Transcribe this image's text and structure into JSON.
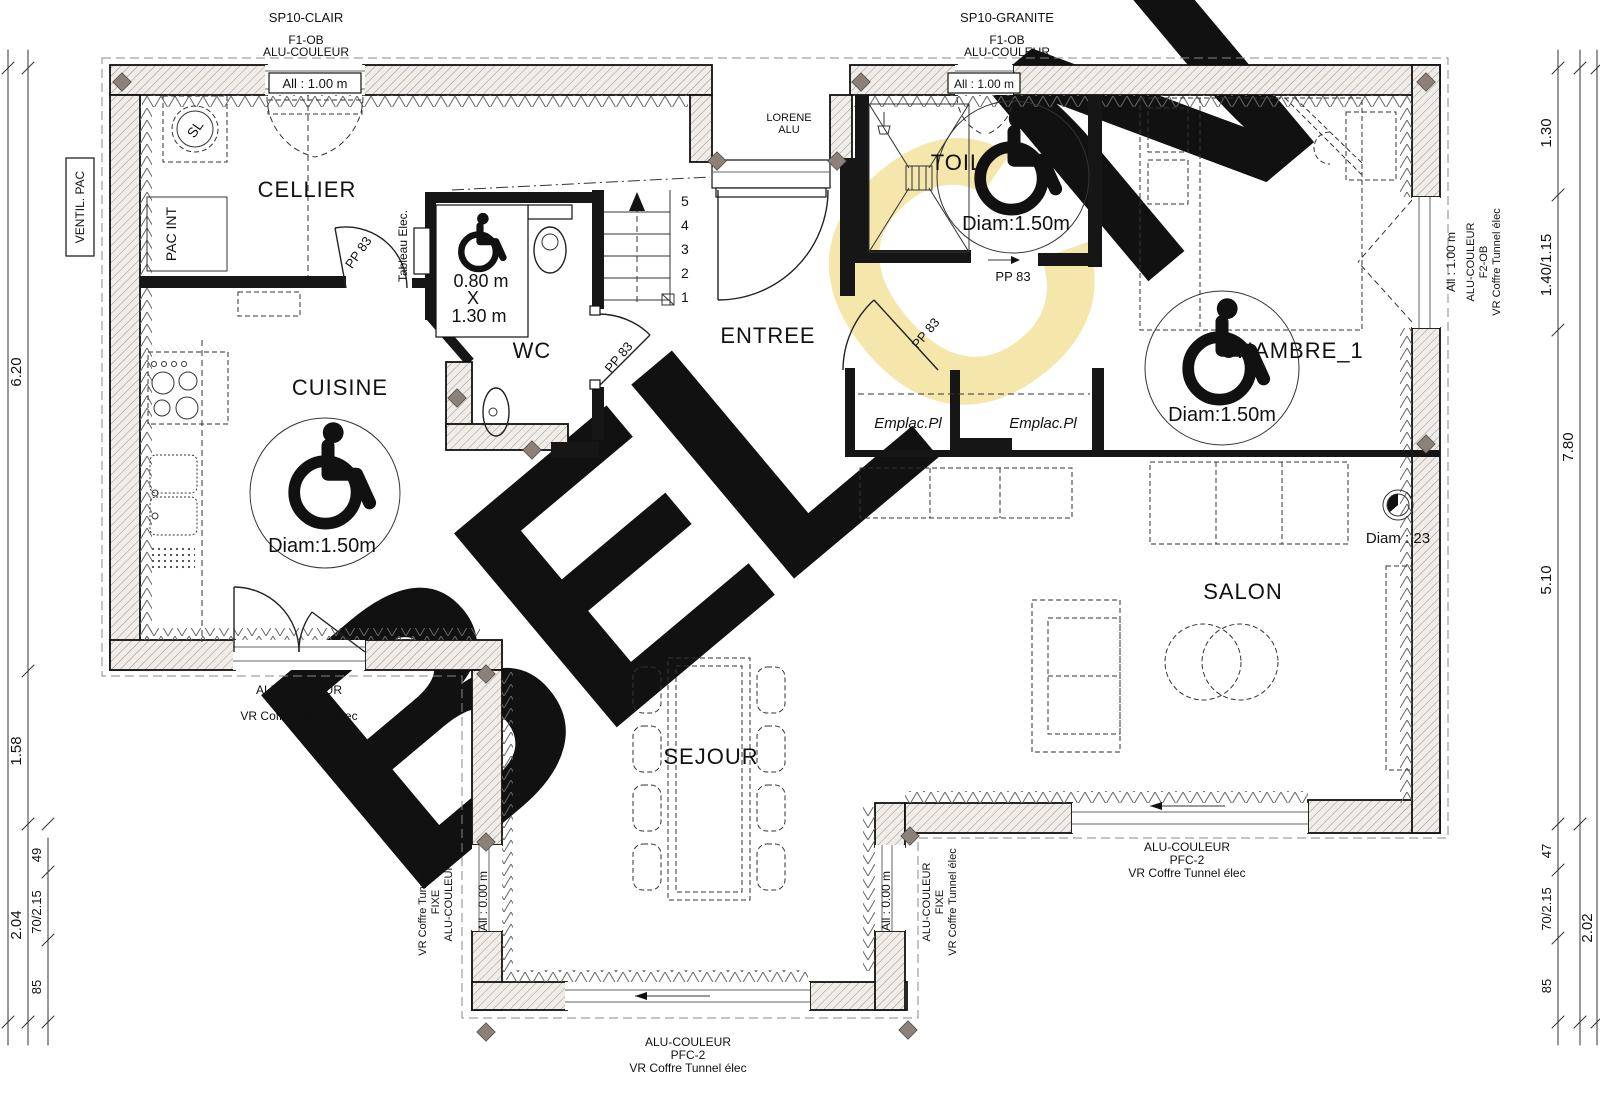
{
  "materials": {
    "left": "SP10-CLAIR",
    "right": "SP10-GRANITE"
  },
  "frames": {
    "ref": "F1-OB",
    "color": "ALU-COULEUR"
  },
  "entry": {
    "brand": "LORENE",
    "material": "ALU"
  },
  "sills": {
    "s100": "All : 1.00 m",
    "s000": "All : 0.00 m"
  },
  "door_ref": "PP 83",
  "rooms": {
    "cellier": "CELLIER",
    "cuisine": "CUISINE",
    "wc": "WC",
    "entree": "ENTREE",
    "toil": "TOIL",
    "chambre": "CHAMBRE_1",
    "salon": "SALON",
    "sejour": "SEJOUR"
  },
  "clearance": {
    "turn": "Diam:1.50m",
    "wc_w": "0.80 m",
    "wc_x": "X",
    "wc_h": "1.30 m"
  },
  "duct": "Diam : 23",
  "closet": "Emplac.Pl",
  "equipment": {
    "ventil": "VENTIL. PAC",
    "pac": "PAC INT",
    "tableau": "Tableau Elec.",
    "washer": "SL"
  },
  "windows": {
    "pf2": {
      "l1": "ALU-COULEUR",
      "l2": "PF2",
      "l3": "VR Coffre Tunnel élec"
    },
    "pfc2": {
      "l1": "ALU-COULEUR",
      "l2": "PFC-2",
      "l3": "VR Coffre Tunnel élec"
    },
    "fixe_left": {
      "l1": "VR Coffre Tunnel élec",
      "l2": "FIXE",
      "l3": "ALU-COULEUR"
    },
    "fixe_right": {
      "l1": "ALU-COULEUR",
      "l2": "FIXE",
      "l3": "VR Coffre Tunnel élec"
    },
    "f2ob": {
      "l1": "ALU-COULEUR",
      "l2": "F2-OB",
      "l3": "VR Coffre Tunnel élec"
    }
  },
  "stairs": {
    "s5": "5",
    "s4": "4",
    "s3": "3",
    "s2": "2",
    "s1": "1"
  },
  "dims": {
    "left": {
      "d620": "6.20",
      "d158": "1.58",
      "d204": "2.04",
      "d49": "49",
      "d70": "70/2.15",
      "d85": "85"
    },
    "right": {
      "d130": "1.30",
      "d140": "1.40/1.15",
      "d780": "7.80",
      "d510": "5.10",
      "d47": "47",
      "d70": "70/2.15",
      "d202": "2.02",
      "d85": "85"
    }
  },
  "watermark": {
    "b": "B",
    "e": "E",
    "l": "L",
    "c": "C",
    "n": "N",
    "gray": "#d7d7d7",
    "yellow": "#f5e6ac"
  }
}
